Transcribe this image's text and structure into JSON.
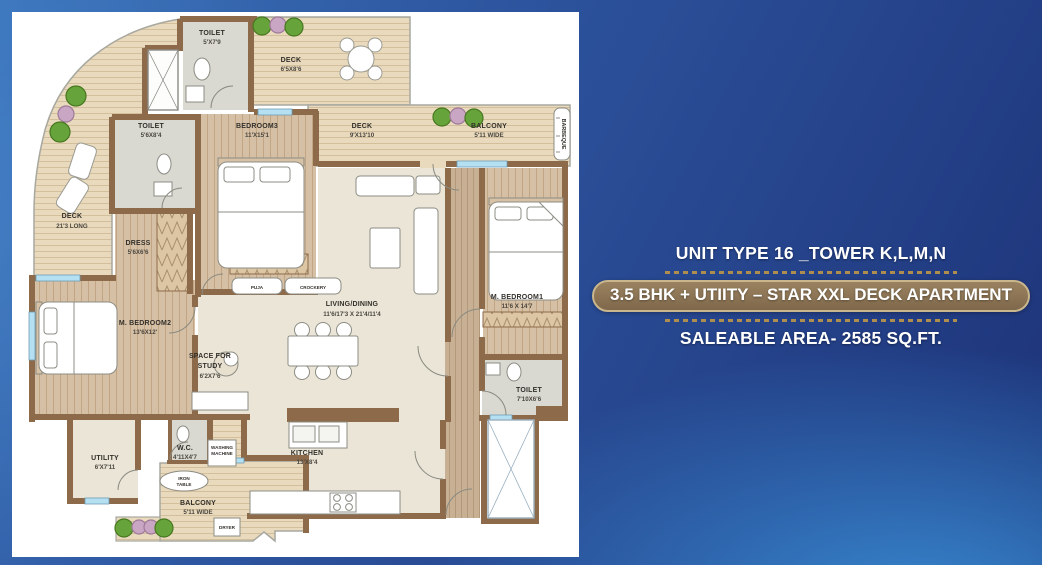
{
  "info": {
    "line1": "UNIT TYPE 16 _TOWER K,L,M,N",
    "badge": "3.5 BHK + UTIITY – STAR XXL DECK APARTMENT",
    "line3": "SALEABLE AREA- 2585 SQ.FT.",
    "colors": {
      "badge_bg": "#8c7355",
      "badge_border": "#c9b68c",
      "dots": "#b5924c",
      "text": "#ffffff"
    }
  },
  "plan": {
    "rooms": {
      "toilet_top": {
        "name": "TOILET",
        "dims": "5'X7'9"
      },
      "deck_top": {
        "name": "DECK",
        "dims": "6'5X8'6"
      },
      "toilet_left": {
        "name": "TOILET",
        "dims": "5'6X8'4"
      },
      "bedroom3": {
        "name": "BEDROOM3",
        "dims": "11'X15'1"
      },
      "deck_mid": {
        "name": "DECK",
        "dims": "9'X13'10"
      },
      "balcony_top": {
        "name": "BALCONY",
        "dims": "5'11 WIDE"
      },
      "deck_left": {
        "name": "DECK",
        "dims": "21'3 LONG"
      },
      "dress": {
        "name": "DRESS",
        "dims": "5'6X6'6"
      },
      "mbedroom2": {
        "name": "M. BEDROOM2",
        "dims": "13'6X12'"
      },
      "living": {
        "name": "LIVING/DINING",
        "dims": "11'6/17'3 X 21'4/11'4"
      },
      "mbedroom1": {
        "name": "M. BEDROOM1",
        "dims": "11'6 X 14'7"
      },
      "toilet_m1": {
        "name": "TOILET",
        "dims": "7'10X6'6"
      },
      "kitchen": {
        "name": "KITCHEN",
        "dims": "13'X8'4"
      },
      "utility": {
        "name": "UTILITY",
        "dims": "6'X7'11"
      },
      "wc": {
        "name": "W.C.",
        "dims": "4'11X4'7"
      },
      "balcony_bot": {
        "name": "BALCONY",
        "dims": "5'11 WIDE"
      }
    },
    "study": {
      "line1": "SPACE FOR",
      "line2": "STUDY",
      "dims": "6'2X7'6"
    },
    "features": {
      "barbeque": "BARBEQUE",
      "puja": "PUJA",
      "crockery": "CROCKERY",
      "washing_line1": "WASHING",
      "washing_line2": "MACHINE",
      "iron_line1": "IRON",
      "iron_line2": "TABLE",
      "dryer": "DRYER"
    }
  }
}
